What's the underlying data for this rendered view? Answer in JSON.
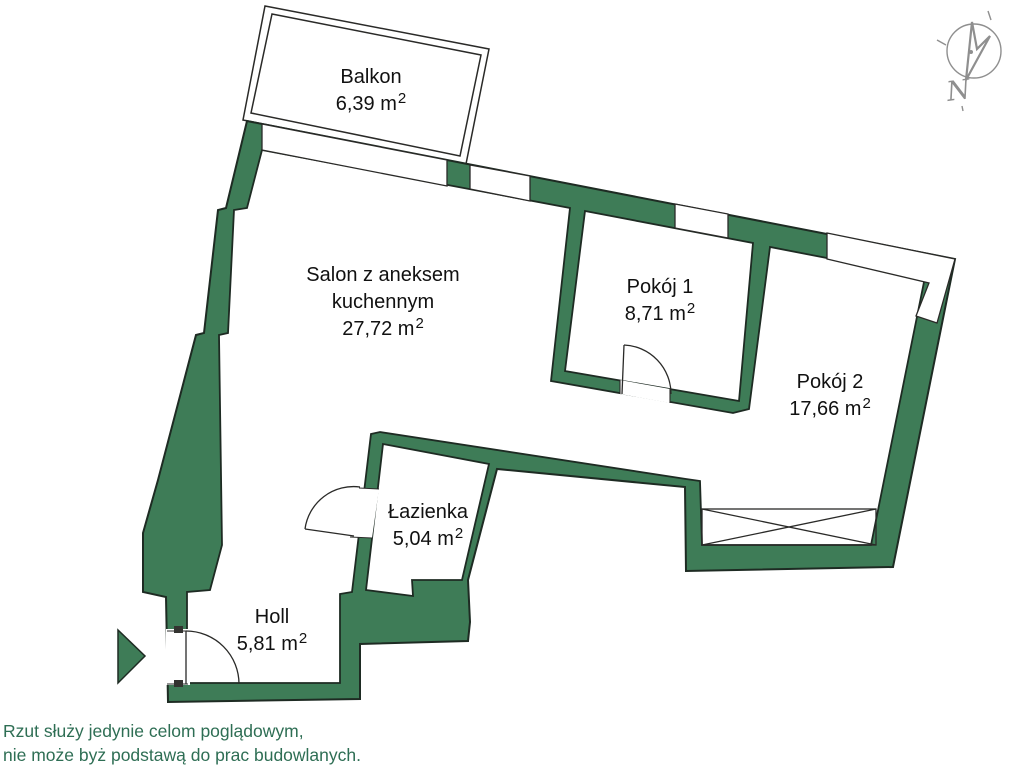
{
  "floorplan": {
    "rooms": [
      {
        "id": "balkon",
        "name": "Balkon",
        "name2": "",
        "area": "6,39 m",
        "sup": "2"
      },
      {
        "id": "salon",
        "name": "Salon z aneksem",
        "name2": "kuchennym",
        "area": "27,72 m",
        "sup": "2"
      },
      {
        "id": "pokoj1",
        "name": "Pokój 1",
        "name2": "",
        "area": "8,71 m",
        "sup": "2"
      },
      {
        "id": "pokoj2",
        "name": "Pokój 2",
        "name2": "",
        "area": "17,66 m",
        "sup": "2"
      },
      {
        "id": "lazienka",
        "name": "Łazienka",
        "name2": "",
        "area": "5,04 m",
        "sup": "2"
      },
      {
        "id": "holl",
        "name": "Holl",
        "name2": "",
        "area": "5,81 m",
        "sup": "2"
      }
    ],
    "disclaimer": {
      "line1": "Rzut służy jedynie celom poglądowym,",
      "line2": "nie może byż podstawą do prac budowlanych."
    },
    "compass": {
      "label": "N"
    },
    "colors": {
      "wall": "#3E7C57",
      "outline": "#1E2B23",
      "disclaimer_text": "#2E6E54",
      "label_text": "#111111",
      "compass": "#8F8F8F"
    }
  }
}
